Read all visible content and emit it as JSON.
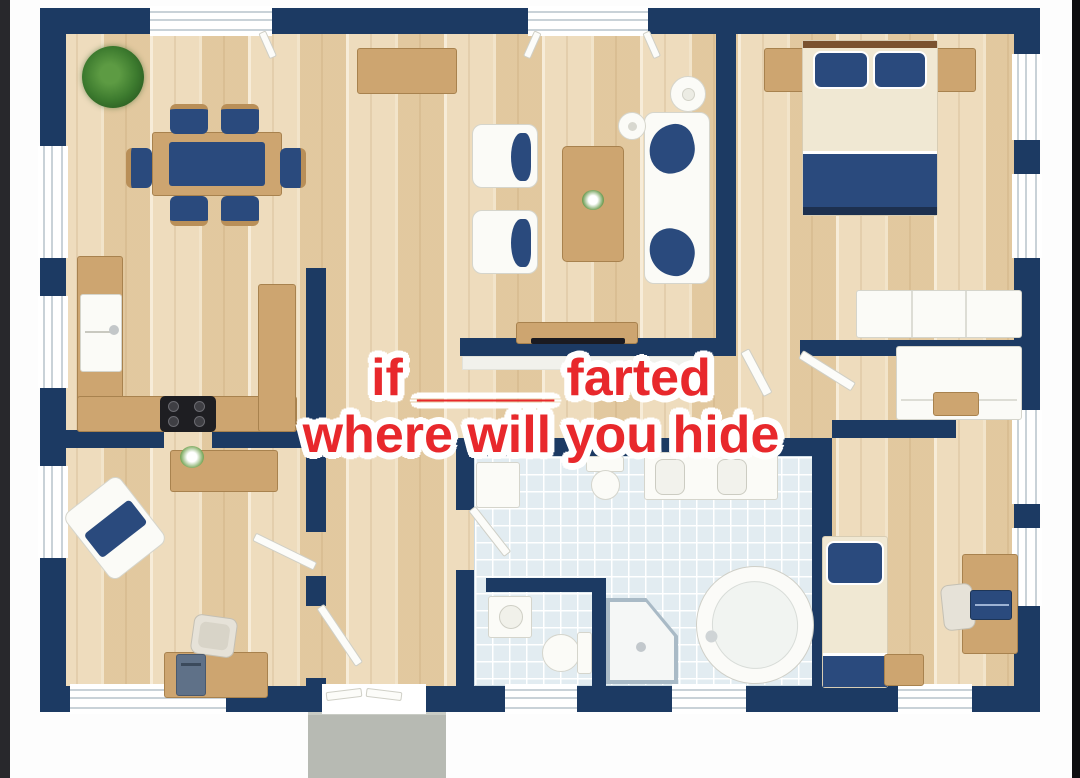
{
  "overlay": {
    "line1_before": "if",
    "line1_blank": "_____",
    "line1_after": "farted",
    "line2": "where will you hide"
  },
  "palette": {
    "wall_navy": "#1c3a63",
    "floor_wood": "#e9d2ab",
    "furniture_wood": "#cda570",
    "wood_border": "#a8824e",
    "textile_navy": "#2a4a7d",
    "cream": "#f0e8d3",
    "tile_blue": "#e2ecf1",
    "mat_gray": "#b7bab3",
    "text_red": "#e8282c",
    "text_outline": "#ffffff",
    "bar_left": "#28282c",
    "bar_right": "#0e0e10"
  }
}
